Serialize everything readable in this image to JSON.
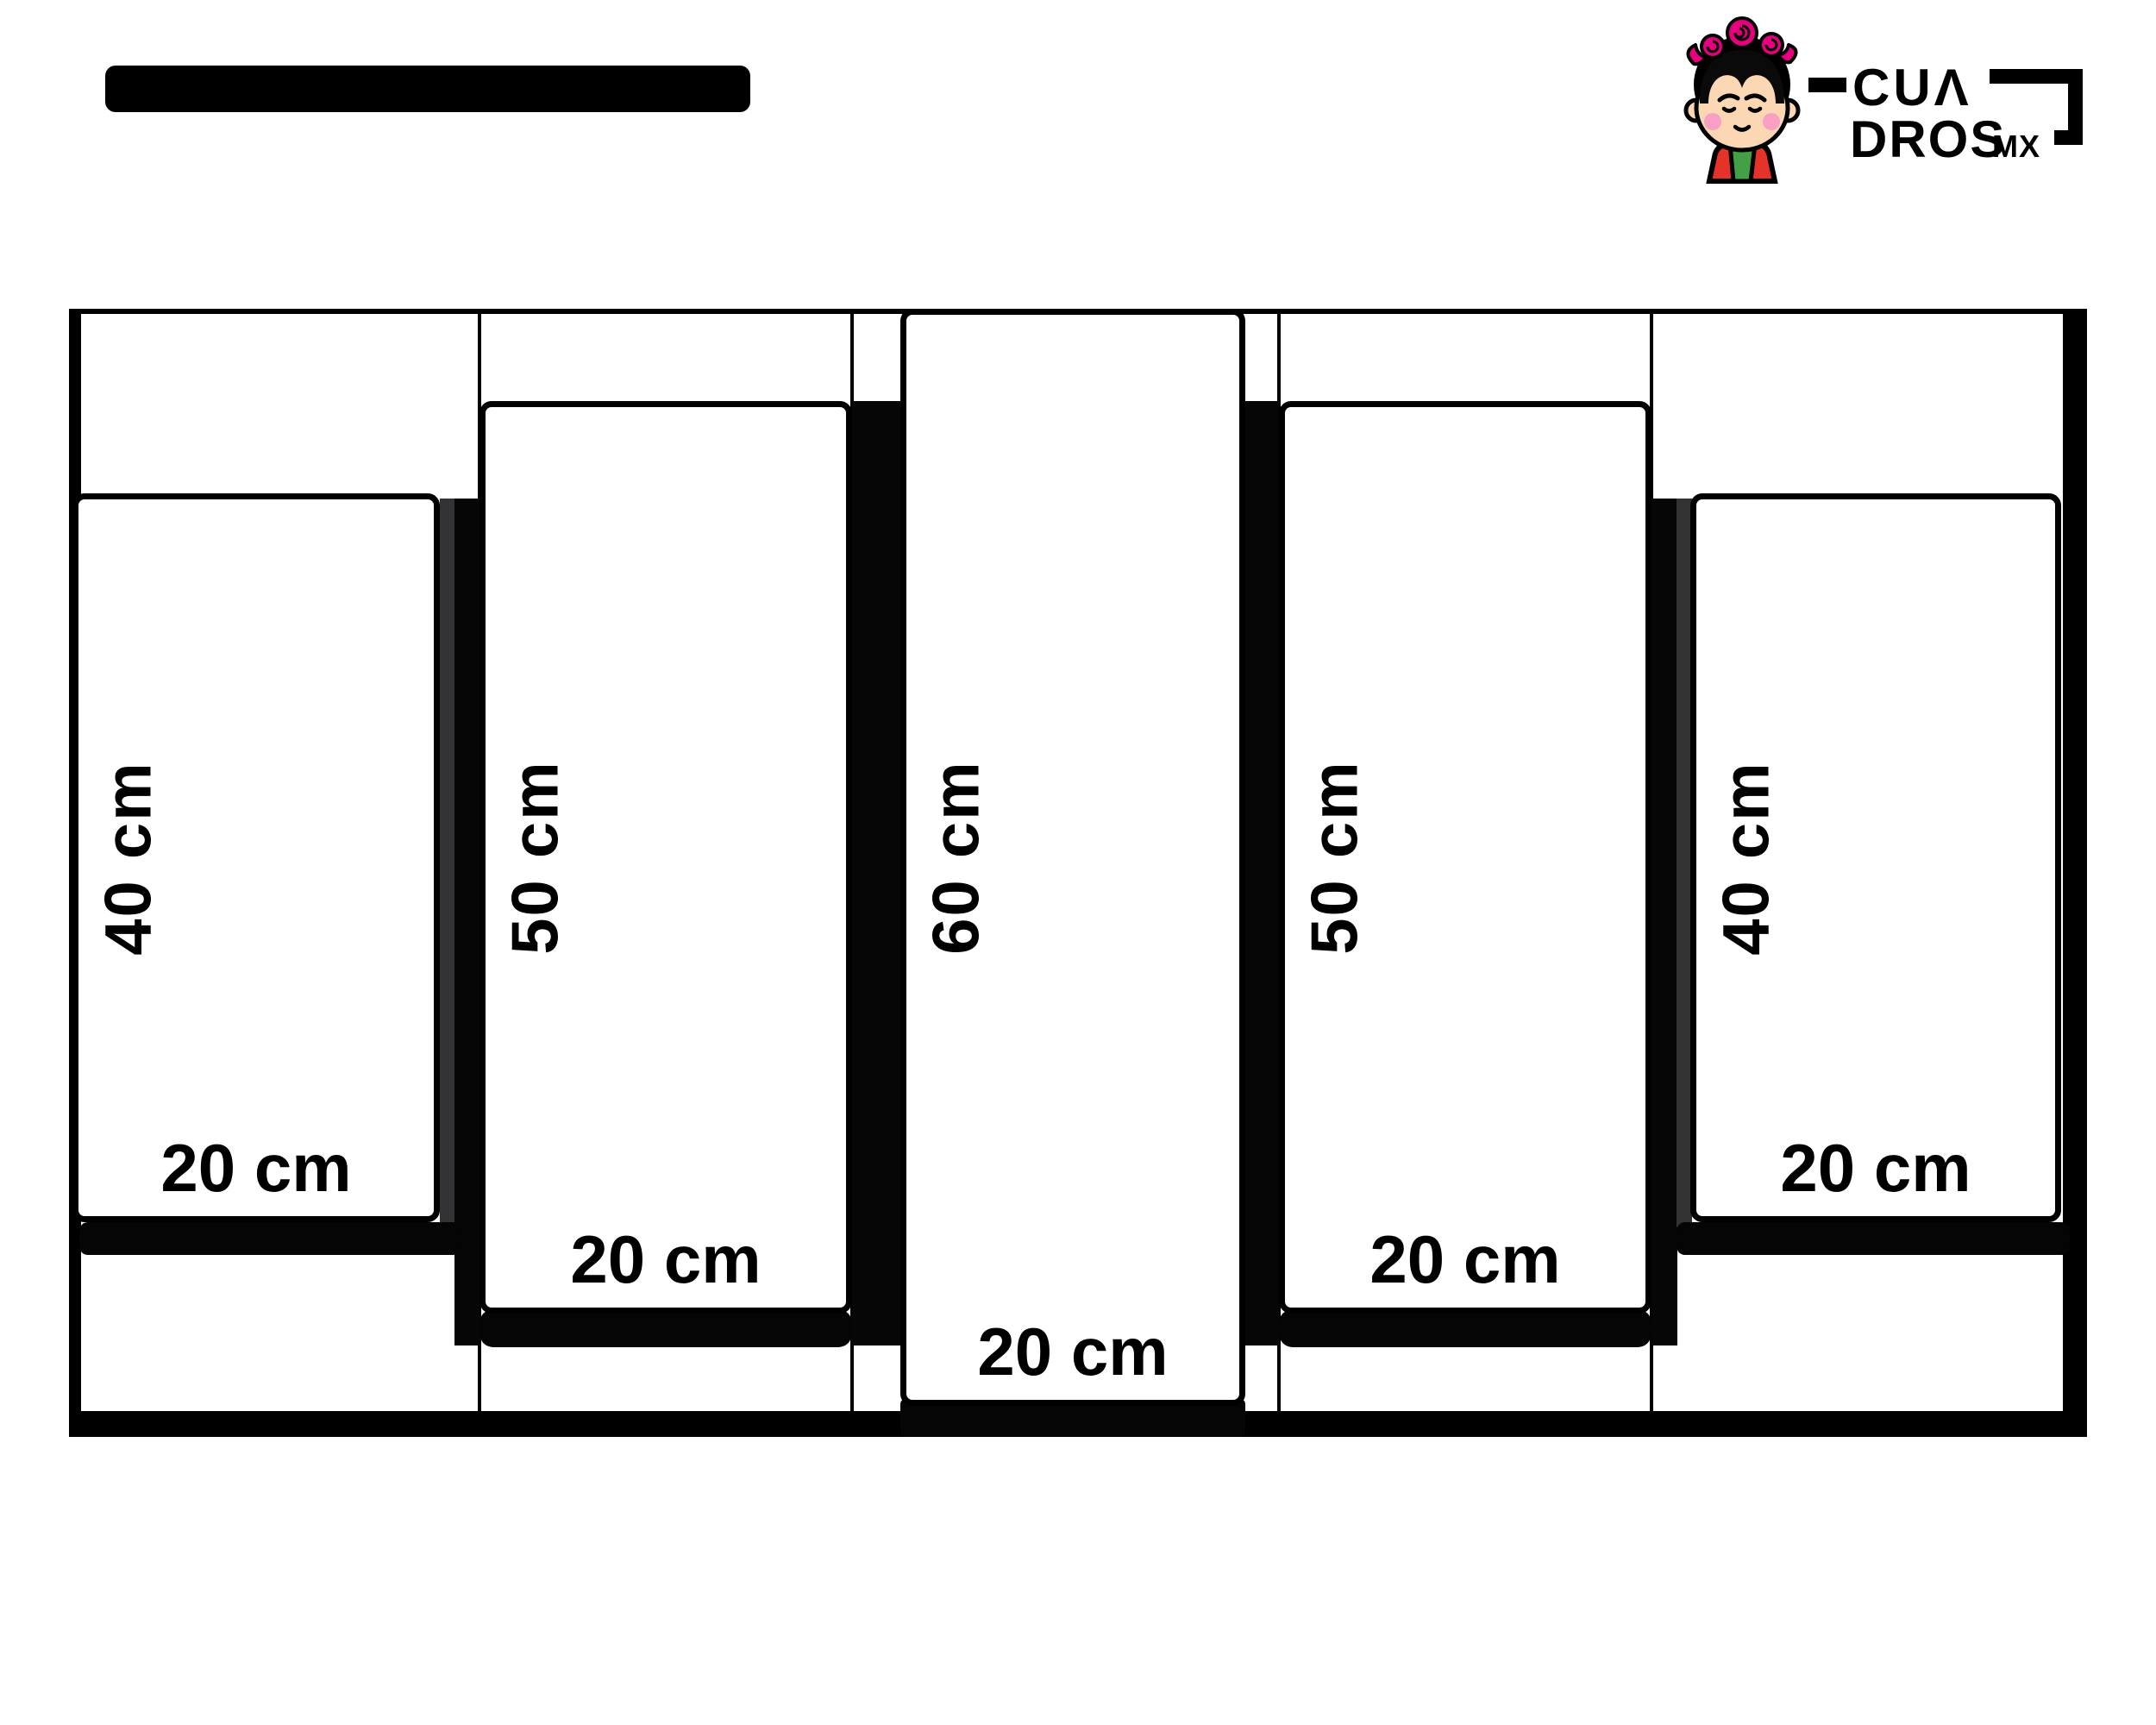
{
  "page": {
    "background": "#ffffff"
  },
  "header": {
    "redacted_title_bar_color": "#000000",
    "logo": {
      "brand_top": "CUΛ",
      "brand_bottom": "DROS",
      "brand_suffix": "MX",
      "colors": {
        "ink": "#000000",
        "pink": "#e6007e",
        "skin": "#fcd7b3",
        "blush": "#f7a0c3",
        "red": "#e63329",
        "green": "#43a047"
      }
    }
  },
  "diagram": {
    "type": "panel-size-diagram",
    "unit": "cm",
    "total_panels": 5,
    "panels": [
      {
        "name": "left-outer",
        "height_cm": 40,
        "width_cm": 20,
        "height_label": "40 cm",
        "width_label": "20 cm"
      },
      {
        "name": "left-inner",
        "height_cm": 50,
        "width_cm": 20,
        "height_label": "50 cm",
        "width_label": "20 cm"
      },
      {
        "name": "center",
        "height_cm": 60,
        "width_cm": 20,
        "height_label": "60 cm",
        "width_label": "20 cm"
      },
      {
        "name": "right-inner",
        "height_cm": 50,
        "width_cm": 20,
        "height_label": "50 cm",
        "width_label": "20 cm"
      },
      {
        "name": "right-outer",
        "height_cm": 40,
        "width_cm": 20,
        "height_label": "40 cm",
        "width_label": "20 cm"
      }
    ],
    "colors": {
      "outline": "#000000",
      "panel_fill": "#ffffff",
      "shadow_gray": "#333336"
    }
  }
}
